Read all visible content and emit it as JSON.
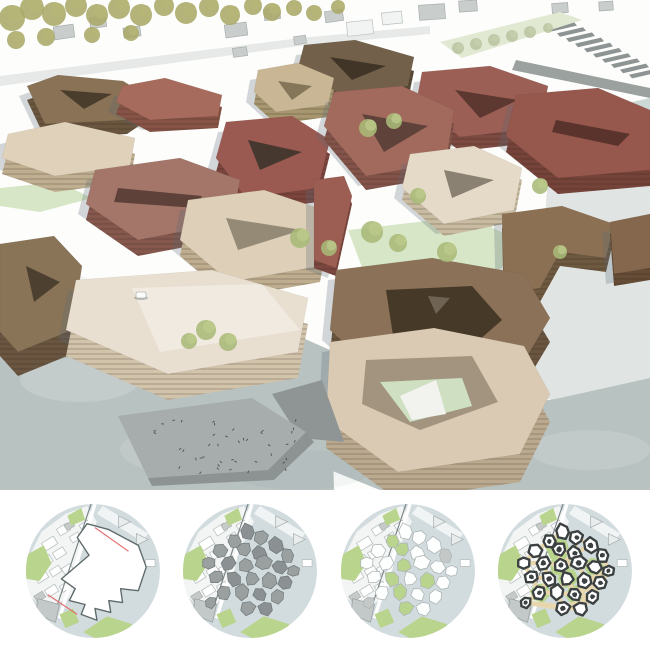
{
  "board": {
    "kind": "architecture-masterplan-presentation",
    "panels": [
      "aerial-axonometric-render",
      "concept-diagram-sequence"
    ]
  },
  "palette": {
    "page_bg": "#ffffff",
    "plaza": "#b8c2c1",
    "plaza_right": "#bdc6c4",
    "context_gray": "#c9cecd",
    "tree_olive": "#a8a868",
    "tree_green": "#a9ba78",
    "lawn": "#d7e6c6",
    "map_water": "#d2dcdf",
    "map_green": "#b9d48c",
    "massing_gray": "#9aa0a0",
    "site_red_line": "#e07070",
    "final_outline": "#3b4041",
    "path_tan": "#e8d7ae"
  },
  "render_scene": {
    "width": 650,
    "height": 490,
    "sky": "#fdfdfc",
    "road_band": "0,76 300,38 430,26 430,34 300,46 0,86",
    "houses": [
      [
        64,
        32,
        20,
        13,
        -8
      ],
      [
        98,
        22,
        16,
        11,
        -8
      ],
      [
        132,
        32,
        17,
        10,
        -8
      ],
      [
        236,
        30,
        22,
        13,
        -8
      ],
      [
        272,
        14,
        16,
        11,
        -8
      ],
      [
        334,
        16,
        18,
        11,
        -8
      ],
      [
        432,
        12,
        26,
        15,
        -4
      ],
      [
        468,
        6,
        18,
        11,
        -4
      ],
      [
        560,
        8,
        16,
        10,
        -4
      ],
      [
        606,
        6,
        14,
        9,
        -4
      ],
      [
        240,
        52,
        14,
        9,
        -8
      ],
      [
        300,
        40,
        12,
        8,
        -8
      ]
    ],
    "white_blocks": [
      [
        360,
        28,
        26,
        14,
        -6
      ],
      [
        392,
        18,
        20,
        12,
        -6
      ]
    ],
    "stairs": {
      "start": [
        548,
        22
      ],
      "dx": 9,
      "dy": 5.2,
      "w": 26,
      "slant": 6,
      "count": 10,
      "fill": "#8e9494"
    },
    "wall": "516,60 650,88 650,98 512,70",
    "canal": "560,118 650,98 650,162 582,172",
    "right_wash": "548,178 650,164 650,398 560,402 470,380 538,300",
    "promenade_lawn": "440,42 560,12 582,20 462,58",
    "plazas": [
      "0,292 130,284 230,306 330,350 334,490 0,490",
      "560,398 650,378 650,490 380,490 330,470 330,440"
    ],
    "washes": [
      [
        80,
        380,
        60,
        22,
        "#ffffff",
        0.16
      ],
      [
        200,
        450,
        80,
        26,
        "#ffffff",
        0.12
      ],
      [
        120,
        330,
        50,
        16,
        "#7e8f94",
        0.1
      ],
      [
        300,
        470,
        70,
        20,
        "#7e8f94",
        0.08
      ],
      [
        590,
        450,
        60,
        20,
        "#ffffff",
        0.14
      ]
    ],
    "pier": "0,268 86,277 92,291 0,285",
    "pier_shade": "0,285 92,291 88,296 0,291",
    "lawns": [
      "336,118 420,108 470,138 418,160 346,150",
      "348,230 470,216 532,248 468,290 366,278",
      "0,188 58,182 92,198 40,212 0,206",
      "432,196 472,190 494,200 452,212"
    ],
    "back_trees": [
      [
        12,
        18,
        13
      ],
      [
        32,
        8,
        12
      ],
      [
        54,
        14,
        12
      ],
      [
        76,
        6,
        11
      ],
      [
        97,
        15,
        11
      ],
      [
        119,
        8,
        11
      ],
      [
        141,
        15,
        11
      ],
      [
        164,
        6,
        10
      ],
      [
        186,
        13,
        11
      ],
      [
        209,
        7,
        10
      ],
      [
        230,
        15,
        10
      ],
      [
        253,
        6,
        9
      ],
      [
        272,
        12,
        9
      ],
      [
        16,
        40,
        9
      ],
      [
        46,
        37,
        9
      ],
      [
        92,
        35,
        8
      ],
      [
        131,
        33,
        8
      ],
      [
        294,
        8,
        8
      ],
      [
        314,
        13,
        8
      ],
      [
        338,
        7,
        7
      ]
    ],
    "promenade_trees": [
      [
        458,
        48,
        6
      ],
      [
        476,
        44,
        6
      ],
      [
        494,
        40,
        6
      ],
      [
        512,
        36,
        6
      ],
      [
        530,
        32,
        6
      ],
      [
        548,
        28,
        5
      ]
    ],
    "front_trees": [
      [
        368,
        128,
        9
      ],
      [
        394,
        121,
        8
      ],
      [
        300,
        238,
        10
      ],
      [
        329,
        248,
        8
      ],
      [
        372,
        232,
        11
      ],
      [
        398,
        243,
        9
      ],
      [
        447,
        252,
        10
      ],
      [
        206,
        330,
        10
      ],
      [
        228,
        342,
        9
      ],
      [
        189,
        341,
        8
      ],
      [
        418,
        196,
        8
      ],
      [
        540,
        186,
        8
      ],
      [
        560,
        252,
        7
      ]
    ],
    "ramp": {
      "deck": "118,416 252,398 306,432 268,470 148,478",
      "edge": "148,478 268,470 306,432 314,442 274,480 152,486",
      "block": "272,394 322,380 344,442 300,438",
      "people_area": [
        156,
        420,
        140,
        52
      ],
      "people_count": 42
    },
    "car": {
      "x": 136,
      "y": 292,
      "w": 10,
      "h": 6
    },
    "buildings": [
      {
        "name": "bldg-top-dark-brown",
        "roof": "304,45 355,40 414,57 408,86 338,93 298,68",
        "h": 14,
        "rc": "#73604a",
        "fc": "#584836",
        "court": "330,57 386,66 352,80",
        "cc": "#413528"
      },
      {
        "name": "bldg-topleft-brown",
        "roof": "27,86 58,75 123,81 155,101 127,120 45,124",
        "h": 14,
        "rc": "#8a7256",
        "fc": "#6a563f",
        "court": "60,90 112,94 84,109",
        "cc": "#4b3d2c"
      },
      {
        "name": "bldg-terracotta-bar",
        "roof": "122,86 165,78 222,95 218,116 150,120 116,102",
        "h": 12,
        "rc": "#a66b5d",
        "fc": "#875346",
        "court": "",
        "cc": ""
      },
      {
        "name": "bldg-tan-court",
        "roof": "258,70 298,63 334,78 328,105 276,112 254,92",
        "h": 12,
        "rc": "#c8b694",
        "fc": "#a7966f",
        "court": "278,81 312,86 292,100",
        "cc": "#857659"
      },
      {
        "name": "bldg-ne-redbrown",
        "roof": "422,72 490,66 548,86 540,128 460,137 416,104",
        "h": 14,
        "rc": "#9b5f55",
        "fc": "#7c4a41",
        "court": "455,90 518,100 480,118",
        "cc": "#5d3831"
      },
      {
        "name": "bldg-east-redbrown",
        "roof": "516,95 598,88 650,110 650,170 558,178 506,136",
        "h": 16,
        "rc": "#96584d",
        "fc": "#76433a",
        "court": "556,120 630,134 618,146 552,132",
        "cc": "#5a332c"
      },
      {
        "name": "bldg-left-beige",
        "roof": "8,134 65,122 135,138 130,166 55,176 2,158",
        "h": 16,
        "rc": "#dfd1ba",
        "fc": "#c0ae91",
        "court": "",
        "cc": ""
      },
      {
        "name": "bldg-mid-brickred",
        "roof": "226,122 292,116 330,140 318,188 246,198 216,158",
        "h": 14,
        "rc": "#9a5a51",
        "fc": "#7b453e",
        "court": "248,140 302,152 260,170",
        "cc": "#47382f"
      },
      {
        "name": "bldg-center-red-court",
        "roof": "334,92 402,86 454,110 446,162 366,176 324,126",
        "h": 14,
        "rc": "#a26a5d",
        "fc": "#83534a",
        "court": "362,114 428,126 384,152",
        "cc": "#5f4239"
      },
      {
        "name": "bldg-center-cream-notch",
        "roof": "410,154 474,146 522,168 514,210 444,224 402,188",
        "h": 12,
        "rc": "#e5dac7",
        "fc": "#c9bba2",
        "court": "444,170 494,180 452,198",
        "cc": "#8b8172"
      },
      {
        "name": "bldg-right-brown-L",
        "roof": "502,214 562,206 614,224 606,258 560,252 540,288 504,294",
        "h": 14,
        "rc": "#8c7054",
        "fc": "#6d5840",
        "court": "",
        "cc": ""
      },
      {
        "name": "bldg-faredge-brown",
        "roof": "610,222 650,214 650,268 614,274",
        "h": 12,
        "rc": "#85674d",
        "fc": "#654c37",
        "court": "",
        "cc": ""
      },
      {
        "name": "bldg-ml-redbrown-slit",
        "roof": "95,170 180,158 240,180 232,222 138,240 86,204",
        "h": 16,
        "rc": "#a4766a",
        "fc": "#86584d",
        "court": "118,188 202,196 196,208 114,202",
        "cc": "#5e423a"
      },
      {
        "name": "bldg-center-beige-slit",
        "roof": "188,200 264,190 330,212 320,266 230,282 180,240",
        "h": 16,
        "rc": "#ddcfb8",
        "fc": "#bfad90",
        "court": "226,218 302,230 238,250",
        "cc": "#948a76"
      },
      {
        "name": "bldg-red-tower",
        "roof": "314,180 344,176 352,196 336,268 314,260",
        "h": 8,
        "rc": "#9c5d53",
        "fc": "#7b463e",
        "court": "",
        "cc": ""
      },
      {
        "name": "bldg-left-tall-brown",
        "roof": "0,244 54,236 82,266 72,330 18,352 0,332",
        "h": 24,
        "rc": "#8a7458",
        "fc": "#695540",
        "court": "26,266 60,282 34,302",
        "cc": "#4e4030"
      },
      {
        "name": "bldg-big-cream",
        "roof": "76,280 212,270 308,298 298,352 168,374 66,330",
        "h": 26,
        "rc": "#e9dfd0",
        "fc": "#d2c3ab",
        "court": "",
        "cc": "",
        "extras": [
          {
            "pts": "132,288 262,284 300,330 160,352",
            "fill": "rgba(255,255,255,0.35)"
          }
        ]
      },
      {
        "name": "bldg-cr-brown-court",
        "roof": "336,270 432,258 524,274 550,318 520,368 388,382 330,330",
        "h": 24,
        "rc": "#8a7157",
        "fc": "#6a5540",
        "court": "386,290 472,286 502,320 470,348 394,342",
        "cc": "#473928",
        "extras": [
          {
            "pts": "428,296 450,298 436,314",
            "fill": "#6f6353"
          }
        ]
      },
      {
        "name": "bldg-front-beige-court",
        "roof": "330,342 434,328 524,346 550,394 520,454 398,472 326,420",
        "h": 28,
        "rc": "#dbcab3",
        "fc": "#baa98e",
        "court": "366,360 472,356 498,402 420,430 362,404",
        "cc": "#a2947e",
        "extras": [
          {
            "pts": "380,382 462,378 472,406 410,422",
            "fill": "#cfe0c2"
          },
          {
            "pts": "400,396 436,380 446,414 412,420",
            "fill": "#f2f3ef"
          }
        ]
      }
    ]
  },
  "diagrams": {
    "circle_radius": 68,
    "lefts": [
      24,
      181,
      339,
      496
    ],
    "steps": [
      {
        "id": "step-site-boundary"
      },
      {
        "id": "step-massing"
      },
      {
        "id": "step-plots-green"
      },
      {
        "id": "step-buildings-paths"
      }
    ],
    "base": {
      "water": "#d2dcdf",
      "city": "-68,-8 -52,-40 -28,-58 -6,-66 4,-50 -12,-18 -22,26 -48,40 -68,22",
      "cityFill": "#f3f5f5",
      "blocks": [
        [
          -44,
          -28,
          14,
          9,
          -32
        ],
        [
          -30,
          -42,
          12,
          8,
          -32
        ],
        [
          -48,
          -10,
          13,
          8,
          -32
        ],
        [
          -34,
          -18,
          12,
          8,
          -32
        ],
        [
          -52,
          6,
          12,
          8,
          -32
        ],
        [
          -38,
          0,
          11,
          7,
          -32
        ],
        [
          -26,
          -2,
          10,
          7,
          -32
        ],
        [
          -42,
          20,
          12,
          8,
          -32
        ],
        [
          -28,
          16,
          10,
          7,
          -32
        ],
        [
          -18,
          -34,
          10,
          7,
          -32
        ],
        [
          -8,
          -46,
          10,
          7,
          -32
        ]
      ],
      "grayBlocks": [
        [
          -24,
          -46,
          9,
          6,
          -32
        ],
        [
          -54,
          26,
          10,
          7,
          -32
        ]
      ],
      "roadBand": "10,-66 56,-38 50,-30 4,-58",
      "rail": [
        [
          -2,
          -68
        ],
        [
          -40,
          46
        ]
      ],
      "railRoad": [
        [
          2,
          -68
        ],
        [
          -34,
          48
        ]
      ],
      "greens": [
        "-68,-16 -50,-26 -42,-8 -54,10 -68,8",
        "-10,62 14,46 40,54 32,66 2,68",
        "-34,44 -20,38 -14,52 -28,58",
        "-26,-56 -12,-64 -8,-52 -22,-46"
      ],
      "triangles": [
        "26,-56 38,-50 26,-44",
        "44,-38 56,-32 44,-26"
      ],
      "grayBuilding": "-56,28 -34,34 -38,52 -58,44",
      "rightBlock": [
        58,
        -8,
        10,
        7,
        0
      ]
    },
    "site": {
      "poly": "-6,-48 16,-42 46,-26 54,-4 46,20 28,18 30,32 16,30 18,42 2,38 4,50 -12,44 -8,34 -24,30 -18,18 -32,8 -4,-16 -16,-34",
      "stroke": "#5e6a6b",
      "lines": [
        "2,-44 36,-20",
        "-46,24 -16,44"
      ]
    },
    "seeds": [
      [
        -2,
        -40,
        9,
        10
      ],
      [
        12,
        -34,
        8,
        40
      ],
      [
        -16,
        -30,
        8,
        0
      ],
      [
        26,
        -26,
        9,
        25
      ],
      [
        -30,
        -20,
        8,
        50
      ],
      [
        -6,
        -22,
        9,
        70
      ],
      [
        10,
        -18,
        8,
        15
      ],
      [
        38,
        -16,
        8,
        0
      ],
      [
        -42,
        -8,
        8,
        30
      ],
      [
        -22,
        -8,
        9,
        60
      ],
      [
        -4,
        -6,
        8,
        20
      ],
      [
        14,
        -8,
        9,
        45
      ],
      [
        30,
        -4,
        8,
        10
      ],
      [
        44,
        0,
        7,
        35
      ],
      [
        -34,
        6,
        8,
        15
      ],
      [
        -16,
        8,
        9,
        40
      ],
      [
        2,
        8,
        8,
        65
      ],
      [
        20,
        10,
        9,
        20
      ],
      [
        36,
        12,
        8,
        50
      ],
      [
        -26,
        22,
        8,
        10
      ],
      [
        -8,
        22,
        9,
        35
      ],
      [
        10,
        24,
        8,
        55
      ],
      [
        28,
        26,
        8,
        25
      ],
      [
        -2,
        38,
        8,
        45
      ],
      [
        16,
        38,
        8,
        15
      ],
      [
        -40,
        32,
        7,
        20
      ]
    ],
    "massing": {
      "fill": "#9aa0a0",
      "stroke": "#6f7677"
    },
    "plots": {
      "fill": "#fdfefe",
      "stroke": "#aeb5b5",
      "green_idx": [
        2,
        5,
        10,
        15,
        17,
        20,
        23
      ],
      "gray_idx": [
        7,
        25
      ],
      "gray": "#c4c9c8"
    },
    "final": {
      "green_idx": [
        5,
        10,
        12,
        16,
        19,
        21
      ],
      "path_width": 4.5,
      "outline_width": 2.4
    }
  }
}
